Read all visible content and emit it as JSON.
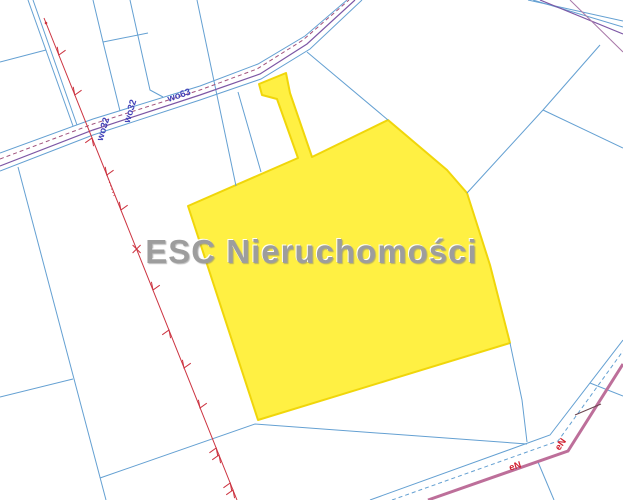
{
  "map": {
    "watermark": "ESC Nieruchomości",
    "road_labels": [
      {
        "text": "wo63"
      },
      {
        "text": "wo32"
      },
      {
        "text": "wo32"
      }
    ],
    "utility_labels": [
      {
        "text": "eN"
      },
      {
        "text": "eN"
      }
    ],
    "colors": {
      "highlight_fill": "#fff043",
      "highlight_stroke": "#f0d60a",
      "boundary_blue": "#64a0d2",
      "road_purple": "#7d57a5",
      "road_dashed_purple": "#a0527d",
      "utility_pink": "#bd6f9a",
      "powerline_red": "#cc3340",
      "label_blue": "#4343b8",
      "label_red": "#d02030",
      "watermark_gray": "#9d9d9d",
      "background": "#ffffff"
    }
  }
}
